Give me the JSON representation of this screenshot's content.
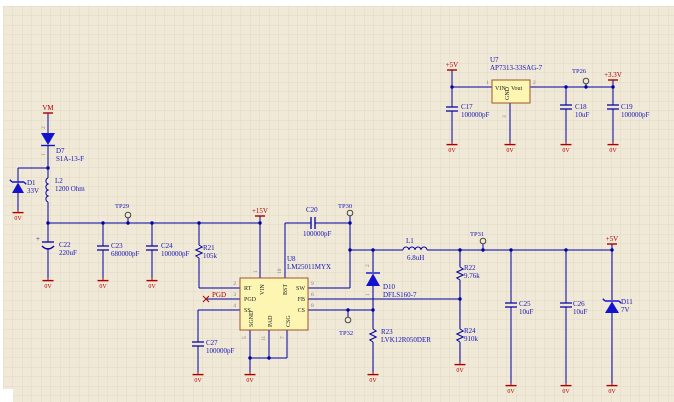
{
  "colors": {
    "wire": "#0000a4",
    "text_blue": "#1414b8",
    "red": "#aa0000",
    "ic_fill": "#fdf6b2",
    "ic_stroke": "#a0522d",
    "sheet_bg": "#f0e9d8",
    "grid": "#e1d9c2"
  },
  "power": {
    "vm": "VM",
    "p5v_in": "+5V",
    "p3v3": "+3.3V",
    "p15v": "+15V",
    "p5v_out": "+5V",
    "gnd": "0V",
    "pgd_net": "PGD"
  },
  "test_points": {
    "tp26": "TP26",
    "tp29": "TP29",
    "tp30": "TP30",
    "tp31": "TP31",
    "tp32": "TP32"
  },
  "u7": {
    "ref": "U7",
    "part": "AP7313-33SAG-7",
    "vin": "VIN",
    "gnd": "GND",
    "vout": "Vout",
    "n1": "1",
    "n2": "2",
    "n3": "3"
  },
  "u8": {
    "ref": "U8",
    "part": "LM25011MYX",
    "rt": "RT",
    "pgd": "PGD",
    "ss": "SS",
    "vin": "VIN",
    "bst": "BST",
    "sw": "SW",
    "fb": "FB",
    "cs": "CS",
    "sgnd": "SGND",
    "pad": "PAD",
    "csg": "CSG",
    "n1": "1",
    "n2": "2",
    "n3": "3",
    "n4": "4",
    "n5": "5",
    "n6": "6",
    "n7": "7",
    "n8": "8",
    "n9": "9",
    "n10": "10",
    "n11": "11"
  },
  "parts": {
    "d7": {
      "ref": "D7",
      "val": "S1A-13-F",
      "n1": "1",
      "n2": "2"
    },
    "d1": {
      "ref": "D1",
      "val": "33V"
    },
    "d10": {
      "ref": "D10",
      "val": "DFLS160-7",
      "n1": "1",
      "n2": "2"
    },
    "d11": {
      "ref": "D11",
      "val": "7V"
    },
    "l1": {
      "ref": "L1",
      "val": "6.8uH"
    },
    "l2": {
      "ref": "L2",
      "val": "1200 Ohm"
    },
    "c17": {
      "ref": "C17",
      "val": "100000pF"
    },
    "c18": {
      "ref": "C18",
      "val": "10uF"
    },
    "c19": {
      "ref": "C19",
      "val": "100000pF"
    },
    "c20": {
      "ref": "C20",
      "val": "100000pF"
    },
    "c22": {
      "ref": "C22",
      "val": "220uF",
      "plus": "+"
    },
    "c23": {
      "ref": "C23",
      "val": "680000pF"
    },
    "c24": {
      "ref": "C24",
      "val": "100000pF"
    },
    "c25": {
      "ref": "C25",
      "val": "10uF"
    },
    "c26": {
      "ref": "C26",
      "val": "10uF"
    },
    "c27": {
      "ref": "C27",
      "val": "100000pF"
    },
    "r21": {
      "ref": "R21",
      "val": "105k"
    },
    "r22": {
      "ref": "R22",
      "val": "9.76k"
    },
    "r23": {
      "ref": "R23",
      "val": "LVK12R050DER"
    },
    "r24": {
      "ref": "R24",
      "val": "910k"
    }
  }
}
